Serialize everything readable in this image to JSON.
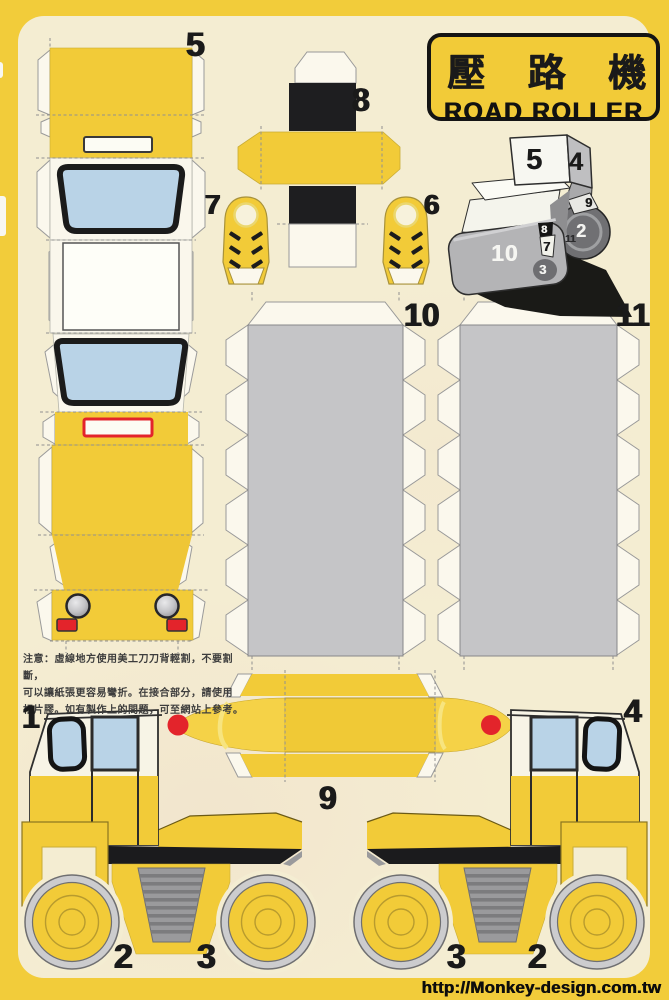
{
  "title": {
    "chinese": "壓 路 機",
    "english": "ROAD ROLLER"
  },
  "website": "http://Monkey-design.com.tw",
  "instructions": {
    "line1": "注意：虛線地方使用美工刀刀背輕割，不要割斷，",
    "line2": "可以讓紙張更容易彎折。在接合部分，請使用",
    "line3": "相片膠。如有製作上的問題，可至網站上參考。"
  },
  "part_labels": {
    "p1": "1",
    "p2_left": "2",
    "p3_left": "3",
    "p3_right": "3",
    "p2_right": "2",
    "p4": "4",
    "p5": "5",
    "p6": "6",
    "p7": "7",
    "p8": "8",
    "p9": "9",
    "p10": "10",
    "p11": "11"
  },
  "reference_labels": {
    "r5": "5",
    "r4": "4",
    "r9": "9",
    "r2": "2",
    "r11": "11",
    "r8": "8",
    "r7": "7",
    "r10": "10",
    "r3": "3"
  },
  "colors": {
    "frame_yellow": "#F2CC3A",
    "part_yellow": "#F2CB38",
    "bright_yellow": "#F5D247",
    "paper_cream": "#F4EDD2",
    "flap_white": "#FBF8ED",
    "window_blue": "#B9D3E7",
    "panel_gray": "#C5C5C7",
    "grille_gray": "#9A9A9C",
    "signal_red": "#E3242B",
    "ink_black": "#1A1A1A"
  }
}
